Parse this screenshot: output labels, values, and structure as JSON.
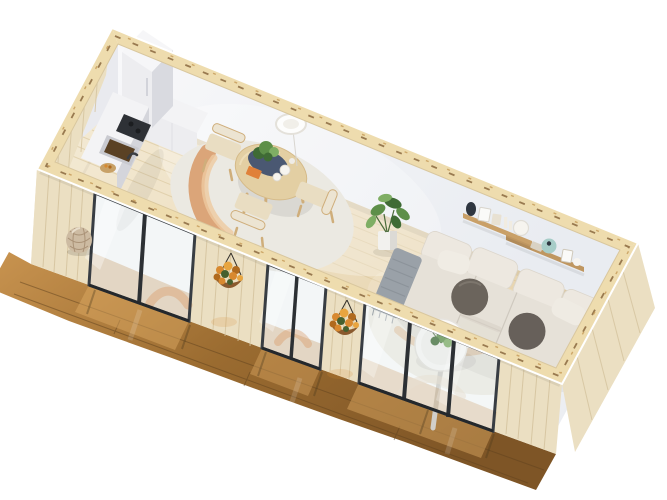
{
  "meta": {
    "subject": "3D isometric cutaway render of a tiny house studio interior",
    "view": "top-down dollhouse cutaway, rotated diagonally",
    "rooms": "open plan: kitchenette, dining area, living area, front deck"
  },
  "scene": {
    "structure": [
      "white interior walls",
      "timber-frame cut wall tops",
      "light pine plank floor",
      "wood slat exterior facade",
      "three glass sliding doors",
      "wooden front deck with reflections"
    ],
    "kitchen": [
      "tall white cabinet",
      "white kitchenette counter",
      "black cooktop",
      "brown sink basin with faucet",
      "wooden fruit bowl"
    ],
    "dining": [
      "round wooden dining table",
      "three wooden chairs with cream cushions",
      "navy centerpiece tray with green plant",
      "orange booklet",
      "white plates",
      "cream rug with terracotta swirl",
      "white pendant lamp"
    ],
    "living": [
      "cream modular sectional sofa",
      "two dark round pillows",
      "white back cushions",
      "gray throw blanket",
      "round white coffee table with plant",
      "cream round rug",
      "wooden wall shelves with decor",
      "dark vase",
      "teal vase",
      "picture frames",
      "candles",
      "potted green plant in white pot"
    ],
    "exterior": [
      "two hanging orange flower baskets",
      "woven round basket on deck"
    ]
  },
  "colors": {
    "background": "#ffffff",
    "timberTop": "#eedcae",
    "timberDash": "#8a6840",
    "timberDashLight": "#c49a58",
    "exteriorWood": "#ebdfc2",
    "exteriorWoodLine": "#d3c29c",
    "interiorWallBack": "#f8f8fa",
    "interiorWallBackDeep": "#e9ecf1",
    "interiorWallLeft": "#e9eaef",
    "interiorWallRight": "#f1f2f5",
    "interiorWallRightDeep": "#e6e9ee",
    "floorLight": "#f4ebd6",
    "floorDeep": "#e6d2ab",
    "floorPlankLine": "#d6c196",
    "deckLight": "#c99450",
    "deckMid": "#9a6b30",
    "deckDark": "#7e5526",
    "deckPlankGap": "#5f421e",
    "deckReflection": "#e0ac66",
    "glass": "#d7e2e4",
    "glassFrame": "#383d43",
    "glassStreak": "#ffffff",
    "kitchenCabinet": "#ededf0",
    "kitchenCabinetSide": "#d9dae0",
    "kitchenCounterTop": "#f3f3f5",
    "kitchenCounterFace": "#d4d5db",
    "cooktop": "#2e3136",
    "sinkBasin": "#5a4124",
    "sinkRim": "#c9cad0",
    "bowlWood": "#c8a167",
    "tableWood": "#e3cfa3",
    "tableWoodRim": "#efe0bc",
    "chairWood": "#cfae7b",
    "chairCushion": "#e9ddc2",
    "chairBack": "#ece4d2",
    "trayNavy": "#415170",
    "bookOrange": "#e0813a",
    "plateWhite": "#f6f4ef",
    "plantGreenDark": "#3f6b35",
    "plantGreen": "#5d8f49",
    "plantGreenLight": "#7fae64",
    "potWhite": "#f2f1ee",
    "potShade": "#dcdad5",
    "rugBase": "#ebe9e2",
    "rugSwirl": "#d68e55",
    "rugSwirlLight": "#eec9a0",
    "livingRug": "#f2eee5",
    "livingRugSwirl": "#e2b183",
    "sofaBase": "#e6e1d8",
    "sofaCushion": "#ede8e0",
    "sofaSeam": "#cfc9bf",
    "sofaShadow": "#d7d1c7",
    "pillowDark": "#6b645c",
    "pillowDark2": "#67605a",
    "throwGray": "#9aa1a8",
    "throwGrayDark": "#868d94",
    "shelfWood": "#c9a068",
    "shelfWood2": "#bf9660",
    "vaseDark": "#2f3640",
    "vaseTeal": "#a7cdc8",
    "frameWhite": "#fafaf8",
    "frameBeige": "#e8e1d2",
    "candleWhite": "#f1ece1",
    "flowerOrange": "#d8892f",
    "flowerOrangeDark": "#b06a1e",
    "flowerOrangeLight": "#e8a53f",
    "flowerGreen": "#46602e",
    "basketWeave": "#cdbba2",
    "basketWeaveLine": "#a68e72",
    "basketCoco": "#8a5a2e",
    "lampWhite": "#fdfdfc",
    "lampRim": "#e4e1da",
    "cordGray": "#d8d5cf",
    "pedestalGray": "#d2cfc9"
  }
}
